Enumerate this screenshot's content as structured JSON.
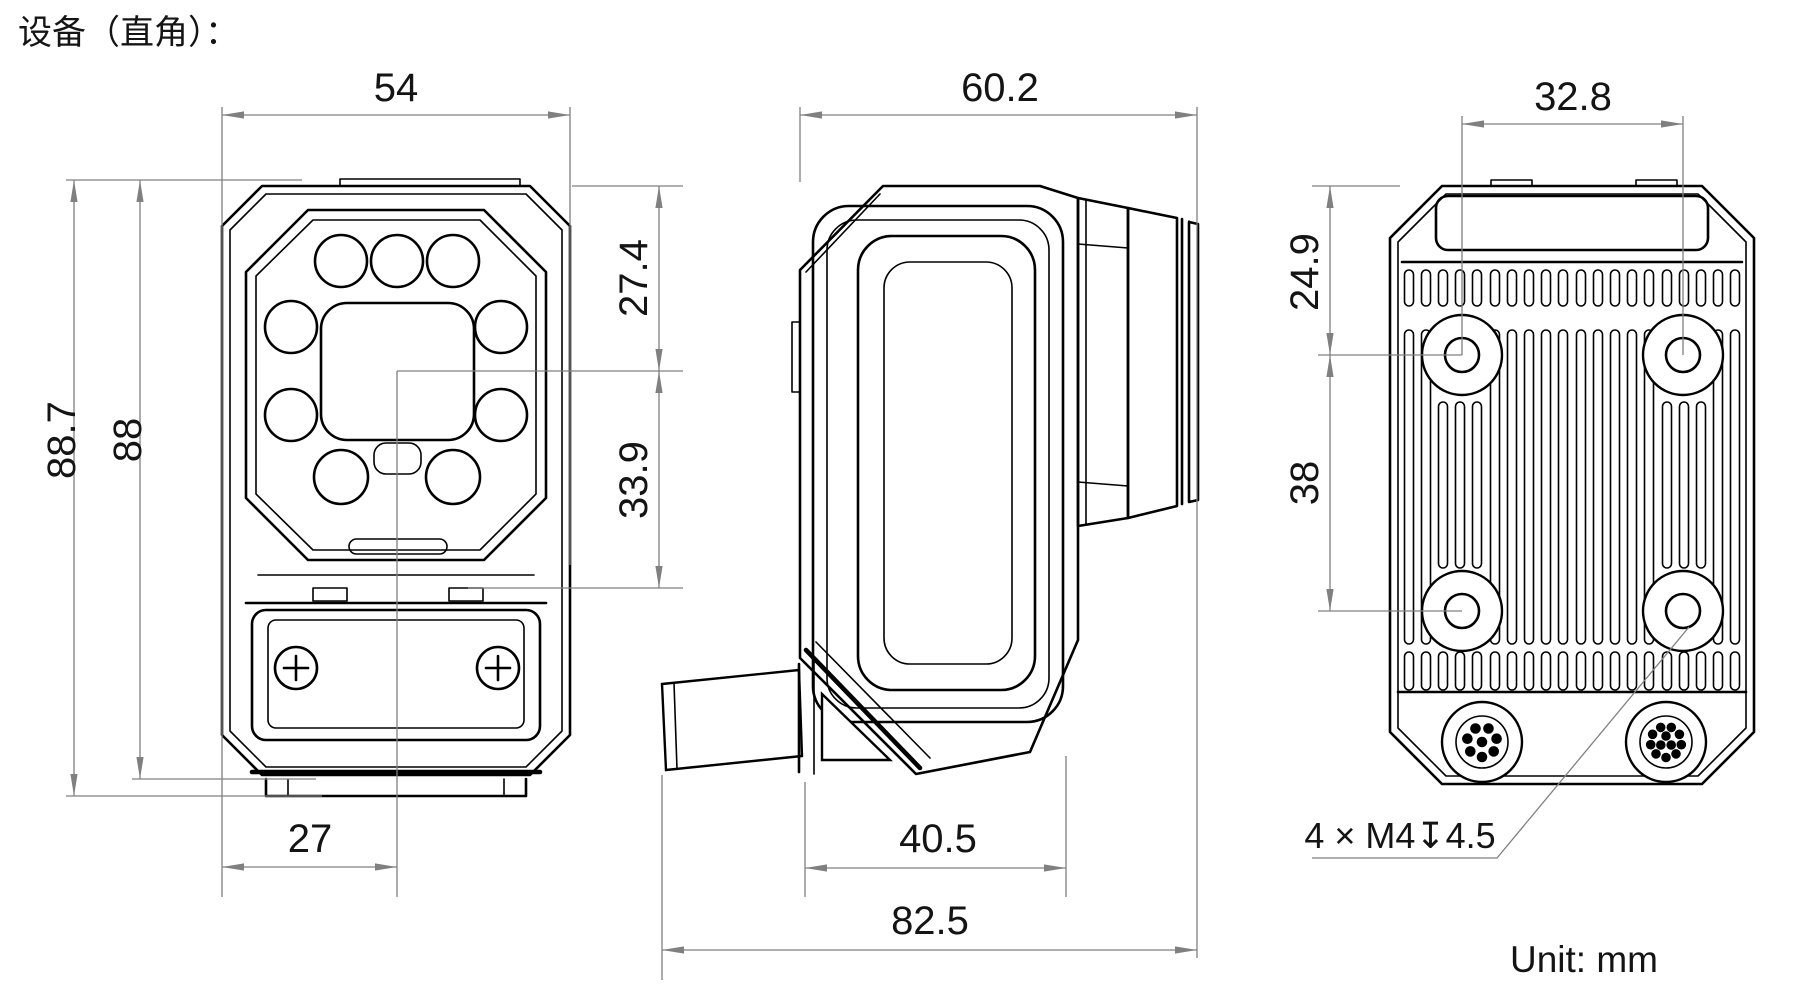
{
  "title": "设备（直角）：",
  "unit_label": "Unit: mm",
  "colors": {
    "line": "#000000",
    "dimension": "#808080",
    "background": "#ffffff"
  },
  "views": {
    "front": {
      "label": "front-view",
      "dims": {
        "width": "54",
        "height_overall": "88.7",
        "height_body": "88",
        "center_offset": "27",
        "lens_center_from_top": "27.4",
        "lens_center_to_latch": "33.9"
      }
    },
    "side": {
      "label": "side-view",
      "dims": {
        "depth": "60.2",
        "body_bottom": "40.5",
        "overall": "82.5"
      }
    },
    "back": {
      "label": "back-view",
      "dims": {
        "hole_spacing_horizontal": "32.8",
        "top_hole_offset": "24.9",
        "hole_spacing_vertical": "38"
      },
      "mount_note": "4 × M4↧4.5"
    }
  }
}
